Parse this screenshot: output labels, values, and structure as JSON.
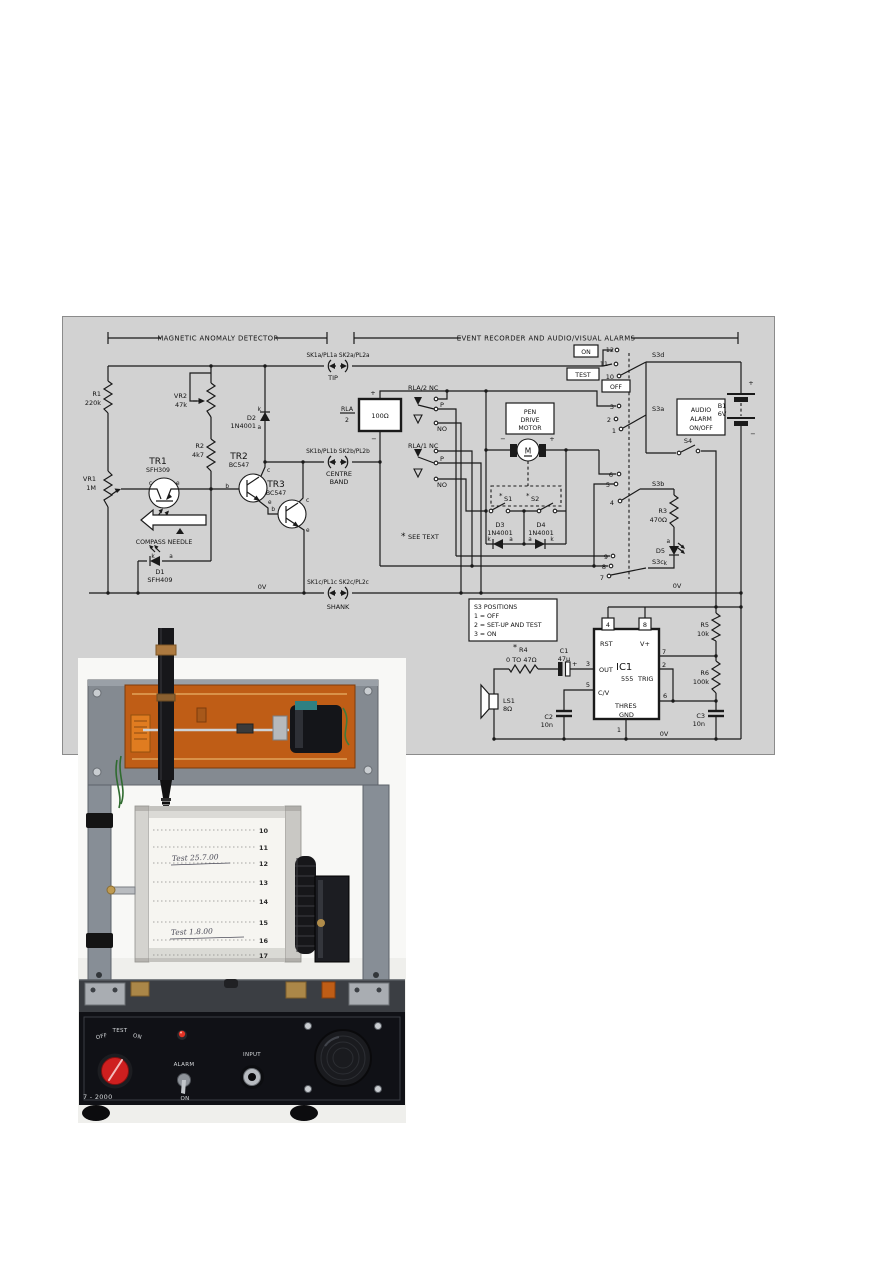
{
  "schematic": {
    "headers": {
      "left": "MAGNETIC ANOMALY DETECTOR",
      "right": "EVENT RECORDER AND AUDIO/VISUAL ALARMS"
    },
    "connectors": {
      "tip": {
        "labels": "SK1a/PL1a  SK2a/PL2a",
        "name": "TIP"
      },
      "cb": {
        "labels": "SK1b/PL1b  SK2b/PL2b",
        "name1": "CENTRE",
        "name2": "BAND"
      },
      "shank": {
        "labels": "SK1c/PL1c  SK2c/PL2c",
        "name": "SHANK"
      }
    },
    "parts": {
      "r1": {
        "ref": "R1",
        "val": "220k"
      },
      "vr2": {
        "ref": "VR2",
        "val": "47k"
      },
      "r2": {
        "ref": "R2",
        "val": "4k7"
      },
      "vr1": {
        "ref": "VR1",
        "val": "1M"
      },
      "tr1": {
        "ref": "TR1",
        "val": "SFH309"
      },
      "tr2": {
        "ref": "TR2",
        "val": "BC547"
      },
      "tr3": {
        "ref": "TR3",
        "val": "BC547"
      },
      "d1": {
        "ref": "D1",
        "val": "SFH409"
      },
      "d2": {
        "ref": "D2",
        "val": "1N4001"
      },
      "d3": {
        "ref": "D3",
        "val": "1N4001"
      },
      "d4": {
        "ref": "D4",
        "val": "1N4001"
      },
      "d5": {
        "ref": "D5"
      },
      "r3": {
        "ref": "R3",
        "val": "470Ω"
      },
      "r4": {
        "ref": "R4",
        "val": "0 TO 47Ω"
      },
      "r5": {
        "ref": "R5",
        "val": "10k"
      },
      "r6": {
        "ref": "R6",
        "val": "100k"
      },
      "c1": {
        "ref": "C1",
        "val": "47µ"
      },
      "c2": {
        "ref": "C2",
        "val": "10n"
      },
      "c3": {
        "ref": "C3",
        "val": "10n"
      },
      "ls1": {
        "ref": "LS1",
        "val": "8Ω"
      },
      "b1": {
        "ref": "B1",
        "val": "6V"
      },
      "relay": {
        "ref": "RLA",
        "den": "2",
        "val": "100Ω"
      },
      "rla1": "RLA/1",
      "rla2": "RLA/2",
      "ic1": {
        "ref": "IC1",
        "val": "555"
      }
    },
    "ic_pins": {
      "rst": "RST",
      "vplus": "V+",
      "out": "OUT",
      "cv": "C/V",
      "disch": "DISCH",
      "trig": "TRIG",
      "thres": "THRES",
      "gnd": "GND",
      "n1": "1",
      "n2": "2",
      "n3": "3",
      "n4": "4",
      "n5": "5",
      "n6": "6",
      "n7": "7",
      "n8": "8"
    },
    "switches": {
      "s1": "S1",
      "s2": "S2",
      "s3a": "S3a",
      "s3b": "S3b",
      "s3c": "S3c",
      "s3d": "S3d",
      "s4": "S4"
    },
    "s3_contacts": {
      "c1": "1",
      "c2": "2",
      "c3": "3",
      "c4": "4",
      "c5": "5",
      "c6": "6",
      "c7": "7",
      "c8": "8",
      "c9": "9",
      "c10": "10",
      "c11": "11",
      "c12": "12"
    },
    "mode_labels": {
      "on": "ON",
      "test": "TEST",
      "off": "OFF"
    },
    "contact_labels": {
      "nc": "NC",
      "p": "P",
      "no": "NO"
    },
    "boxes": {
      "motor": [
        "PEN",
        "DRIVE",
        "MOTOR"
      ],
      "audio": [
        "AUDIO",
        "ALARM",
        "ON/OFF"
      ],
      "s3pos": [
        "S3 POSITIONS",
        "1 = OFF",
        "2 = SET-UP AND TEST",
        "3 = ON"
      ]
    },
    "notes": {
      "star": "*",
      "see_text": "SEE TEXT",
      "compass": "COMPASS NEEDLE",
      "zero_v": "0V",
      "motor_m": "M",
      "plus": "+",
      "minus": "−"
    },
    "pins": {
      "a": "a",
      "k": "k",
      "b": "b",
      "c": "c",
      "e": "e"
    }
  },
  "photo": {
    "chart": {
      "numbers": [
        "10",
        "11",
        "12",
        "13",
        "14",
        "15",
        "16",
        "17"
      ],
      "note1": "Test 25.7.00",
      "note2": "Test 1.8.00"
    },
    "front_panel": {
      "off": "OFF",
      "test": "TEST",
      "on": "ON",
      "alarm": "ALARM",
      "alarm_on": "ON",
      "input": "INPUT",
      "model": "7 - 2000"
    }
  }
}
